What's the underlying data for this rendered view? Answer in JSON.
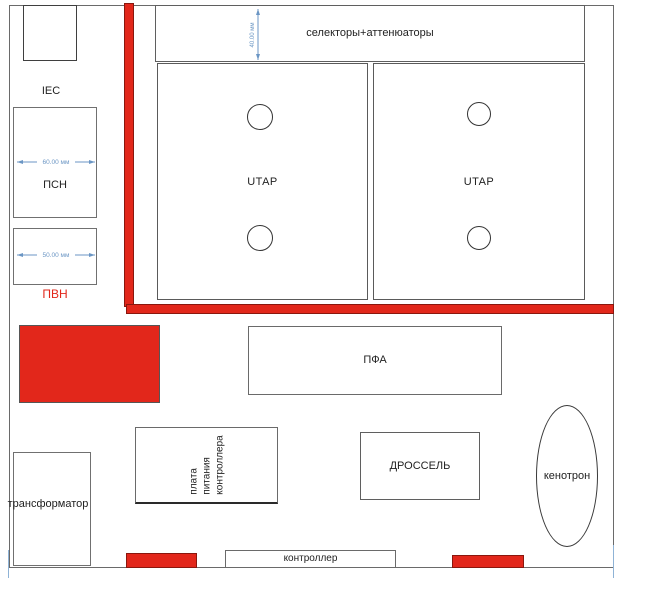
{
  "colors": {
    "red": "#e2271b",
    "red_border": "#8a170e",
    "dimension_blue": "#6b96c4",
    "pvn_label_red": "#e2271b",
    "border_gray": "#666666"
  },
  "blocks": {
    "iec_module": {
      "label": "IEC"
    },
    "psn_module": {
      "label": "ПСН",
      "width_dimension": "60.00 мм"
    },
    "pvn_module": {
      "label": "ПВН",
      "width_dimension": "50.00 мм"
    },
    "selectors_attenuators": {
      "label": "селекторы+аттенюаторы",
      "height_dimension": "40.00 мм"
    },
    "utap_left": {
      "label": "UTAP"
    },
    "utap_right": {
      "label": "UTAP"
    },
    "pfa_module": {
      "label": "ПФА"
    },
    "controller_power_board": {
      "line1": "плата",
      "line2": "питания",
      "line3": "контроллера"
    },
    "choke": {
      "label": "ДРОССЕЛЬ"
    },
    "kenotron": {
      "label": "кенотрон"
    },
    "transformer": {
      "label": "трансформатор"
    },
    "controller": {
      "label": "контроллер"
    }
  }
}
